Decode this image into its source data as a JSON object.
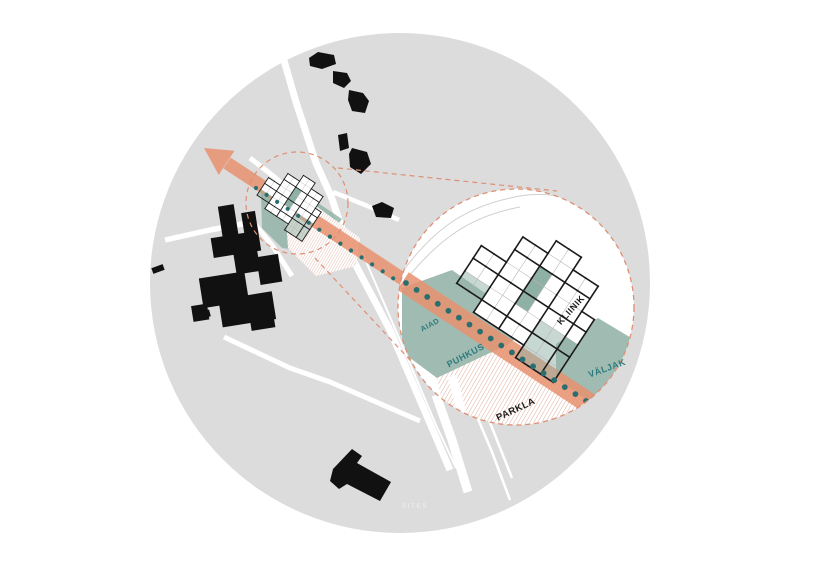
{
  "diagram": {
    "watermark": "SITES",
    "labels": {
      "aiad": "AIAD",
      "puhkus": "PUHKUS",
      "kliinik": "KLIINIK",
      "valjak": "VÄLJAK",
      "parkla": "PARKLA"
    }
  },
  "colors": {
    "background": "#ffffff",
    "map_gray": "#dcdcdc",
    "road_white": "#ffffff",
    "building_black": "#111111",
    "axis_salmon": "#e8916f",
    "dashed_salmon": "#de8f73",
    "teal_area": "#8fb0a4",
    "teal_area_light": "rgba(143,176,164,0.5)",
    "dot_teal": "#2a6f6f",
    "label_teal": "#2e7b7d",
    "label_black": "#1c1c1c",
    "hatch_salmon": "#dca493",
    "grid_thick_line": "#1b1b1b",
    "grid_thin_line": "#b5b5b5"
  },
  "grid": {
    "rows": [
      "....WW...",
      "..WWWWWW.",
      "..WWTWWW.",
      "WWWWTWWWW",
      "WWWWTWWWW",
      "LLWWWWLLL",
      "..WWWWLLL",
      "......LLL"
    ]
  }
}
